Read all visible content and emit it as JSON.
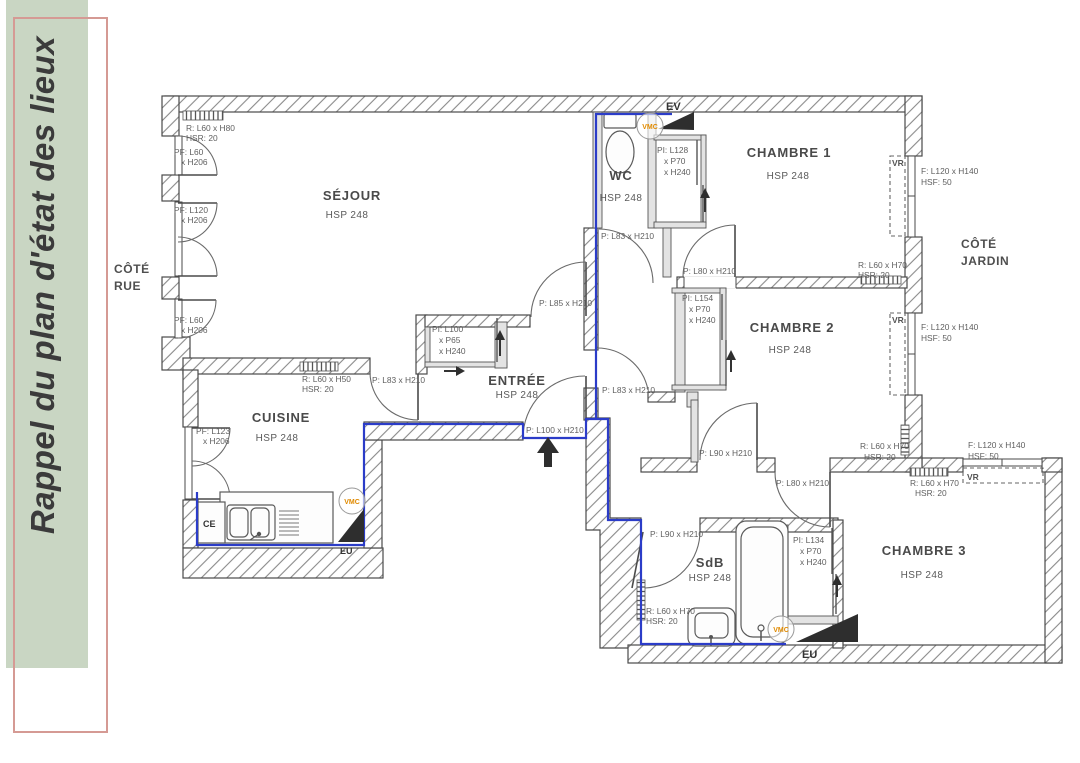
{
  "sidebar": {
    "title": "Rappel du plan d'état des lieux"
  },
  "colors": {
    "sidebar_green": "#c9d6c3",
    "frame_pink": "#d59a94",
    "plumbing_blue": "#2b3cc8",
    "vmc_orange": "#e08a00",
    "wall_gray": "#4a4a4a"
  },
  "side_labels": {
    "rue": [
      "CÔTÉ",
      "RUE"
    ],
    "jardin": [
      "CÔTÉ",
      "JARDIN"
    ]
  },
  "rooms": {
    "sejour": {
      "name": "SÉJOUR",
      "hsp": "HSP 248"
    },
    "cuisine": {
      "name": "CUISINE",
      "hsp": "HSP 248"
    },
    "entree": {
      "name": "ENTRÉE",
      "hsp": "HSP 248"
    },
    "wc": {
      "name": "WC",
      "hsp": "HSP 248"
    },
    "chambre1": {
      "name": "CHAMBRE 1",
      "hsp": "HSP 248"
    },
    "chambre2": {
      "name": "CHAMBRE 2",
      "hsp": "HSP 248"
    },
    "chambre3": {
      "name": "CHAMBRE 3",
      "hsp": "HSP 248"
    },
    "sdb": {
      "name": "SdB",
      "hsp": "HSP 248"
    }
  },
  "annotations": {
    "rad_sejour": [
      "R: L60 x H80",
      "HSR: 20"
    ],
    "pf_sejour_1": [
      "PF: L60",
      "x H206"
    ],
    "pf_sejour_2": [
      "PF: L120",
      "x H206"
    ],
    "pf_sejour_3": [
      "PF: L60",
      "x H206"
    ],
    "pf_cuisine": [
      "PF: L123",
      "x H206"
    ],
    "rad_cuisine": [
      "R: L60 x H50",
      "HSR: 20"
    ],
    "door_cuisine": "P: L83 x H210",
    "closet_entree": [
      "PI: L100",
      "x P65",
      "x H240"
    ],
    "door_sejour": "P: L85 x H210",
    "door_entree": "P: L100 x H210",
    "door_wc": "P: L83 x H210",
    "door_hall": "P: L83 x H210",
    "closet_ch1": [
      "PI: L128",
      "x P70",
      "x H240"
    ],
    "door_ch1": "P: L80 x H210",
    "closet_ch2": [
      "PI: L154",
      "x P70",
      "x H240"
    ],
    "rad_ch1": [
      "R: L60 x H70",
      "HSR: 20"
    ],
    "rad_ch2": [
      "R: L60 x H70",
      "HSR: 20"
    ],
    "rad_ch3": [
      "R: L60 x H70",
      "HSR: 20"
    ],
    "rad_sdb": [
      "R: L60 x H70",
      "HSR: 20"
    ],
    "window1": [
      "F: L120 x H140",
      "HSF: 50"
    ],
    "window2": [
      "F: L120 x H140",
      "HSF: 50"
    ],
    "window3": [
      "F: L120 x H140",
      "HSF: 50"
    ],
    "door_ch2": "P: L90 x H210",
    "door_ch3": "P: L80 x H210",
    "door_sdb": "P: L90 x H210",
    "closet_sdb": [
      "PI: L134",
      "x P70",
      "x H240"
    ],
    "vr": "VR",
    "ev": "EV",
    "eu": "EU",
    "ce": "CE",
    "vmc": "VMC"
  }
}
